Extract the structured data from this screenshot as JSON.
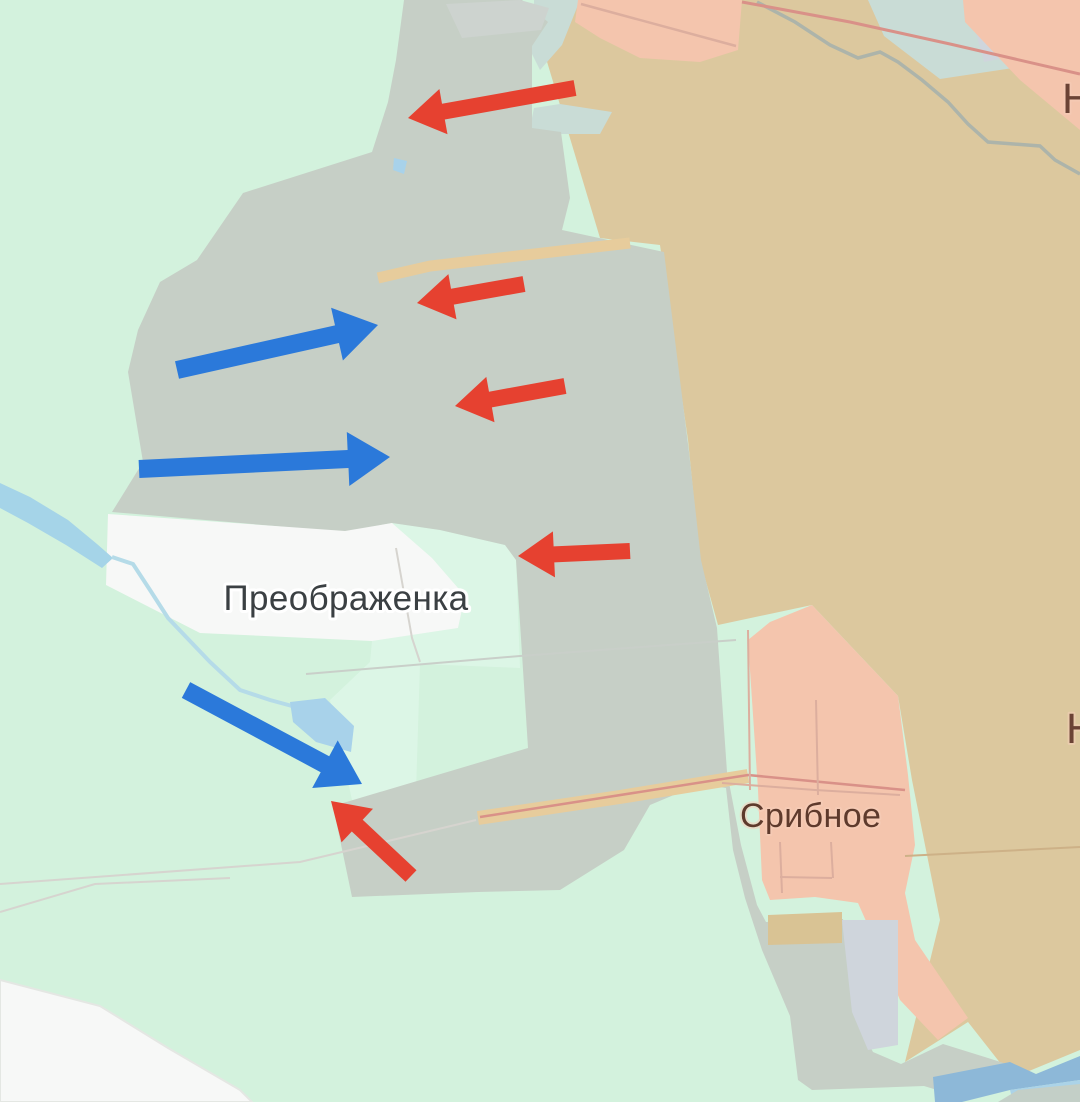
{
  "map": {
    "labels": {
      "primary_settlement": "Преображенка",
      "secondary_settlement": "Срибное",
      "edge_partial_top": "Н",
      "edge_partial_right": "Н"
    },
    "colors": {
      "controlled_mint": "#d3f2dd",
      "controlled_mint_light": "#dcf6e6",
      "contested_gray": "#c6cfc6",
      "occupied_tan": "#dcc89e",
      "captured_salmon": "#f4c5ad",
      "settlement_white": "#f7f8f7",
      "patch_gray": "#cdd3cf",
      "patch_lavender": "#cfd5dc",
      "patch_teal": "#c9dcd6",
      "patch_khaki": "#d9c394",
      "river_wide": "#a5d4e8",
      "stream_thin": "#b5dbe8",
      "pond_blue": "#a8d2ea",
      "water_dark": "#8db8d8",
      "water_light": "#abd3e8",
      "corner_gray": "#c3cfc7",
      "road_fill": "#e7cc9c",
      "road_red_line": "#d99188",
      "field_line_pink": "#dcae9e",
      "field_line_tan": "#cdb187",
      "river_line_gray": "#adb4aa",
      "admin_line": "#c9cfc9",
      "faint_line": "#d6d4cf",
      "arrow_red": "#e64130",
      "arrow_blue": "#2b79da",
      "label_dark": "#3b4043",
      "label_brown": "#5e3a2c",
      "label_brown_light": "#6b4335"
    },
    "arrows": [
      {
        "id": "red-attack-arrow-1",
        "color": "red",
        "from": [
          575,
          88
        ],
        "to": [
          408,
          118
        ]
      },
      {
        "id": "red-attack-arrow-2",
        "color": "red",
        "from": [
          524,
          284
        ],
        "to": [
          417,
          303
        ]
      },
      {
        "id": "red-attack-arrow-3",
        "color": "red",
        "from": [
          565,
          386
        ],
        "to": [
          455,
          406
        ]
      },
      {
        "id": "red-attack-arrow-4",
        "color": "red",
        "from": [
          630,
          551
        ],
        "to": [
          518,
          556
        ]
      },
      {
        "id": "red-attack-arrow-5",
        "color": "red",
        "from": [
          411,
          876
        ],
        "to": [
          331,
          801
        ]
      },
      {
        "id": "blue-counter-arrow-1",
        "color": "blue",
        "from": [
          177,
          370
        ],
        "to": [
          378,
          325
        ]
      },
      {
        "id": "blue-counter-arrow-2",
        "color": "blue",
        "from": [
          139,
          469
        ],
        "to": [
          390,
          457
        ]
      },
      {
        "id": "blue-counter-arrow-3",
        "color": "blue",
        "from": [
          186,
          690
        ],
        "to": [
          362,
          784
        ]
      }
    ],
    "arrow_geometry": {
      "red": {
        "shaft_half": 8,
        "head_half": 23,
        "head_len": 36
      },
      "blue": {
        "shaft_half": 9,
        "head_half": 27,
        "head_len": 42
      }
    }
  }
}
